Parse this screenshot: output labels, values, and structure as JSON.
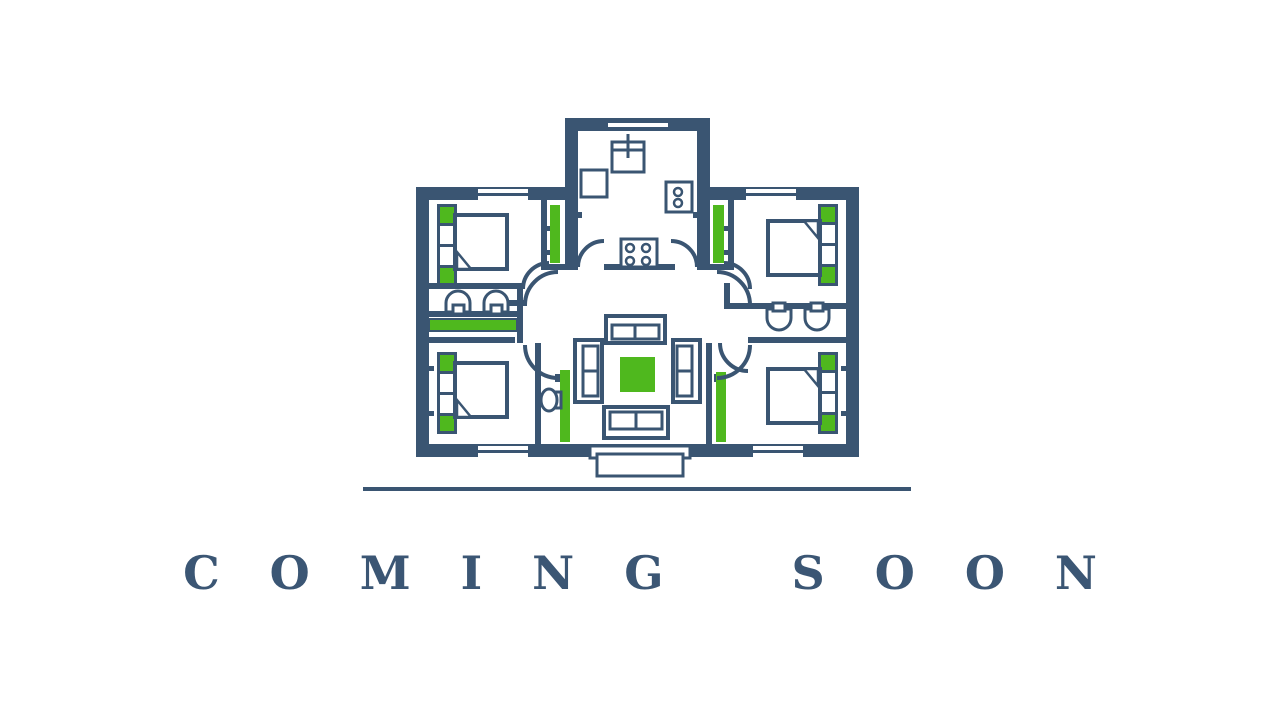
{
  "banner": {
    "title": "COMING SOON"
  },
  "illustration": {
    "type": "house-floor-plan",
    "rooms": [
      "kitchen",
      "living-room",
      "bedroom-top-left",
      "bedroom-top-right",
      "bedroom-bottom-left",
      "bedroom-bottom-right",
      "bathroom-left",
      "bathroom-right",
      "wc"
    ],
    "colors": {
      "navy": "#3a5572",
      "green": "#4fb81e",
      "floor": "#ffffff",
      "text": "#3b5674"
    }
  }
}
